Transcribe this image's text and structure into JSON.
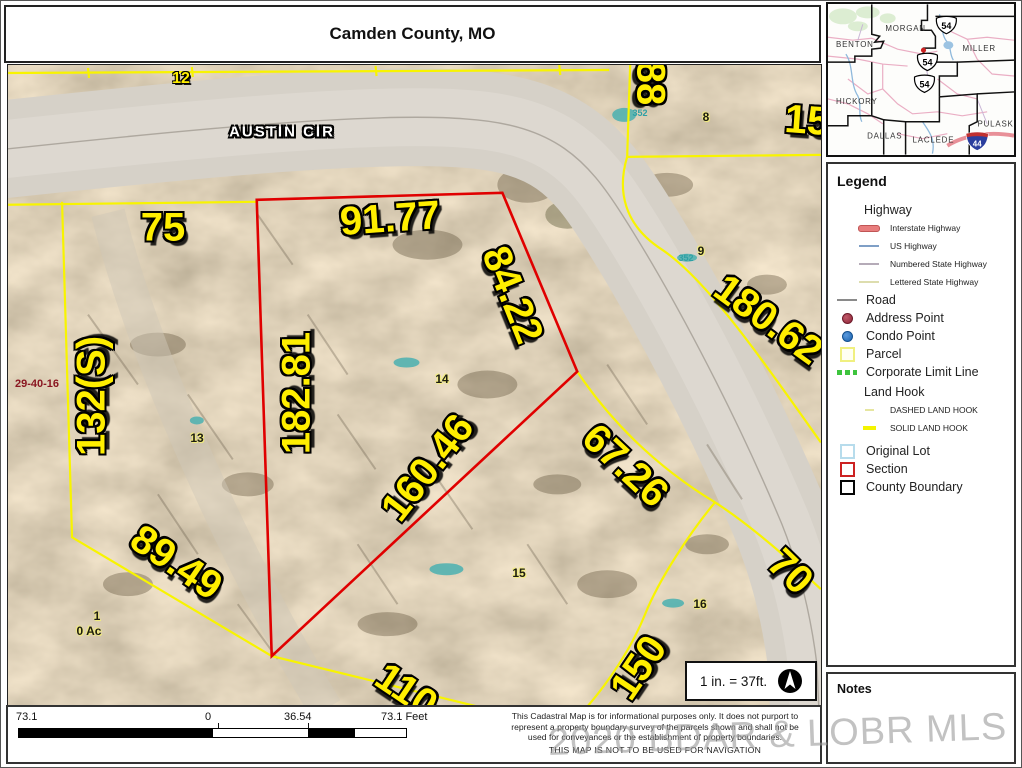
{
  "title": "Camden County, MO",
  "watermark": "2020 BDAR & LOBR MLS",
  "colors": {
    "parcel_yellow": "#f8f400",
    "selected_red": "#e00000",
    "teal_label": "#2fa0a5",
    "watermark_gray": "#9a9a9a",
    "interstate_legend": "#e87d7d"
  },
  "map": {
    "labels": [
      {
        "text": "AUSTIN CIR",
        "x": 274,
        "y": 67,
        "rot": 0,
        "cls": "road",
        "name": "road-label-austin-cir"
      },
      {
        "text": "12",
        "x": 173,
        "y": 14,
        "rot": 0,
        "cls": "sm-dim",
        "name": "dimension-label"
      },
      {
        "text": "75",
        "x": 155,
        "y": 163,
        "rot": 0,
        "cls": "dim",
        "name": "dimension-label"
      },
      {
        "text": "91.77",
        "x": 382,
        "y": 154,
        "rot": -4,
        "cls": "dim",
        "name": "dimension-label"
      },
      {
        "text": "84.22",
        "x": 504,
        "y": 230,
        "rot": 68,
        "cls": "dim",
        "name": "dimension-label"
      },
      {
        "text": "132(S)",
        "x": 84,
        "y": 331,
        "rot": -90,
        "cls": "dim",
        "name": "dimension-label"
      },
      {
        "text": "182.81",
        "x": 289,
        "y": 328,
        "rot": -90,
        "cls": "dim",
        "name": "dimension-label"
      },
      {
        "text": "160.46",
        "x": 420,
        "y": 403,
        "rot": -52,
        "cls": "dim",
        "name": "dimension-label"
      },
      {
        "text": "89.49",
        "x": 168,
        "y": 498,
        "rot": 34,
        "cls": "dim",
        "name": "dimension-label"
      },
      {
        "text": "67.26",
        "x": 617,
        "y": 401,
        "rot": 43,
        "cls": "dim",
        "name": "dimension-label"
      },
      {
        "text": "180.62",
        "x": 760,
        "y": 255,
        "rot": 36,
        "cls": "dim",
        "name": "dimension-label"
      },
      {
        "text": "70",
        "x": 782,
        "y": 507,
        "rot": 44,
        "cls": "dim",
        "name": "dimension-label"
      },
      {
        "text": "110",
        "x": 398,
        "y": 626,
        "rot": 34,
        "cls": "dim",
        "name": "dimension-label"
      },
      {
        "text": "150",
        "x": 631,
        "y": 603,
        "rot": -56,
        "cls": "dim",
        "name": "dimension-label"
      },
      {
        "text": "88",
        "x": 642,
        "y": 18,
        "rot": 90,
        "cls": "dim",
        "name": "dimension-label"
      },
      {
        "text": "15",
        "x": 799,
        "y": 56,
        "rot": 4,
        "cls": "dim",
        "name": "dimension-label"
      },
      {
        "text": "8",
        "x": 698,
        "y": 52,
        "rot": 0,
        "cls": "lot",
        "name": "lot-number"
      },
      {
        "text": "9",
        "x": 693,
        "y": 186,
        "rot": 0,
        "cls": "lot",
        "name": "lot-number"
      },
      {
        "text": "13",
        "x": 189,
        "y": 373,
        "rot": 0,
        "cls": "lot",
        "name": "lot-number"
      },
      {
        "text": "14",
        "x": 434,
        "y": 314,
        "rot": 0,
        "cls": "lot",
        "name": "lot-number"
      },
      {
        "text": "15",
        "x": 511,
        "y": 508,
        "rot": 0,
        "cls": "lot",
        "name": "lot-number"
      },
      {
        "text": "16",
        "x": 692,
        "y": 539,
        "rot": 0,
        "cls": "lot",
        "name": "lot-number"
      },
      {
        "text": "1",
        "x": 89,
        "y": 551,
        "rot": 0,
        "cls": "lot",
        "name": "lot-number"
      },
      {
        "text": "0 Ac",
        "x": 81,
        "y": 566,
        "rot": 0,
        "cls": "lot",
        "name": "acreage-label"
      },
      {
        "text": "352",
        "x": 632,
        "y": 48,
        "rot": 0,
        "cls": "teal",
        "name": "condo-number"
      },
      {
        "text": "352",
        "x": 678,
        "y": 193,
        "rot": 0,
        "cls": "teal",
        "name": "condo-number"
      },
      {
        "text": "29-40-16",
        "x": 29,
        "y": 319,
        "rot": 0,
        "cls": "sec",
        "name": "section-township-range-label"
      }
    ]
  },
  "inset": {
    "counties": [
      "MORGAN",
      "BENTON",
      "MILLER",
      "HICKORY",
      "DALLAS",
      "LACLEDE",
      "PULASKI"
    ],
    "us_route": "54",
    "interstate": "44"
  },
  "legend": {
    "title": "Legend",
    "items": [
      {
        "cls": "head",
        "label": "Highway"
      },
      {
        "cls": "sub",
        "swatch": "sw-interstate",
        "label": "Interstate Highway"
      },
      {
        "cls": "sub",
        "swatch": "sw-us",
        "label": "US Highway"
      },
      {
        "cls": "sub",
        "swatch": "sw-numbered",
        "label": "Numbered State Highway"
      },
      {
        "cls": "sub",
        "swatch": "sw-lettered",
        "label": "Lettered State Highway"
      },
      {
        "cls": "main",
        "swatch": "sw-road",
        "label": "Road"
      },
      {
        "cls": "main",
        "swatch": "sw-address",
        "label": "Address Point"
      },
      {
        "cls": "main",
        "swatch": "sw-condo",
        "label": "Condo Point"
      },
      {
        "cls": "main",
        "swatch": "sw-parcel",
        "label": "Parcel"
      },
      {
        "cls": "main",
        "swatch": "sw-corporate",
        "label": "Corporate Limit Line"
      },
      {
        "cls": "head",
        "label": "Land Hook"
      },
      {
        "cls": "sub",
        "swatch": "sw-dashhook",
        "label": "DASHED LAND HOOK"
      },
      {
        "cls": "sub",
        "swatch": "sw-solidhook",
        "label": "SOLID LAND HOOK"
      },
      {
        "cls": "main gap",
        "swatch": "sw-origlot",
        "label": "Original Lot"
      },
      {
        "cls": "main",
        "swatch": "sw-section",
        "label": "Section"
      },
      {
        "cls": "main",
        "swatch": "sw-county",
        "label": "County Boundary"
      }
    ]
  },
  "notes": {
    "title": "Notes"
  },
  "scalebar": {
    "left_label": "73.1",
    "zero_label": "0",
    "mid_label": "36.54",
    "right_label": "73.1 Feet"
  },
  "scalebox": {
    "text": "1 in. = 37ft."
  },
  "disclaimer": {
    "lines": [
      "This Cadastral Map is for informational purposes only.  It does not purport to",
      "represent a property boundary survey of the parcels shown and shall not be",
      "used for conveyances or the establishment of property boundaries.",
      "THIS MAP IS NOT TO BE USED FOR NAVIGATION"
    ]
  }
}
